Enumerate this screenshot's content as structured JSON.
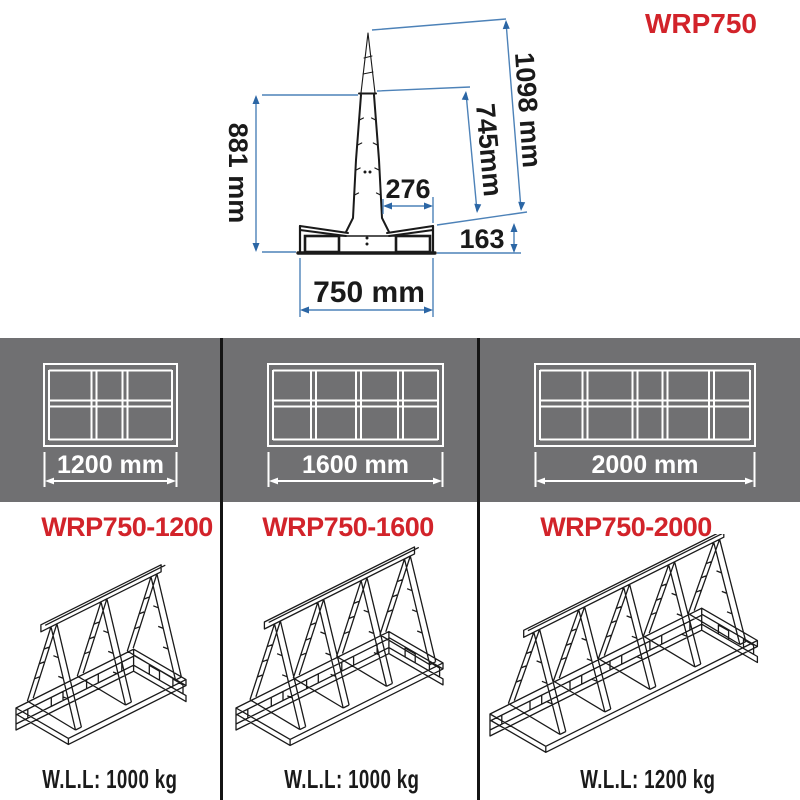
{
  "title": "WRP750",
  "colors": {
    "accent_red": "#d2232a",
    "dimension_blue": "#4d82b8",
    "dimension_arrow_blue": "#2b66a5",
    "band_gray": "#707072",
    "line_black": "#1a1a1a"
  },
  "cross_section": {
    "overall_height": "1098 mm",
    "frame_height": "881 mm",
    "post_height": "745mm",
    "top_offset": "276",
    "base_height": "163",
    "base_width": "750 mm"
  },
  "variants": [
    {
      "model": "WRP750-1200",
      "length": "1200 mm",
      "wll": "W.L.L: 1000 kg",
      "bays": 3,
      "posts": 3
    },
    {
      "model": "WRP750-1600",
      "length": "1600 mm",
      "wll": "W.L.L: 1000 kg",
      "bays": 4,
      "posts": 4
    },
    {
      "model": "WRP750-2000",
      "length": "2000 mm",
      "wll": "W.L.L: 1200 kg",
      "bays": 5,
      "posts": 5
    }
  ]
}
